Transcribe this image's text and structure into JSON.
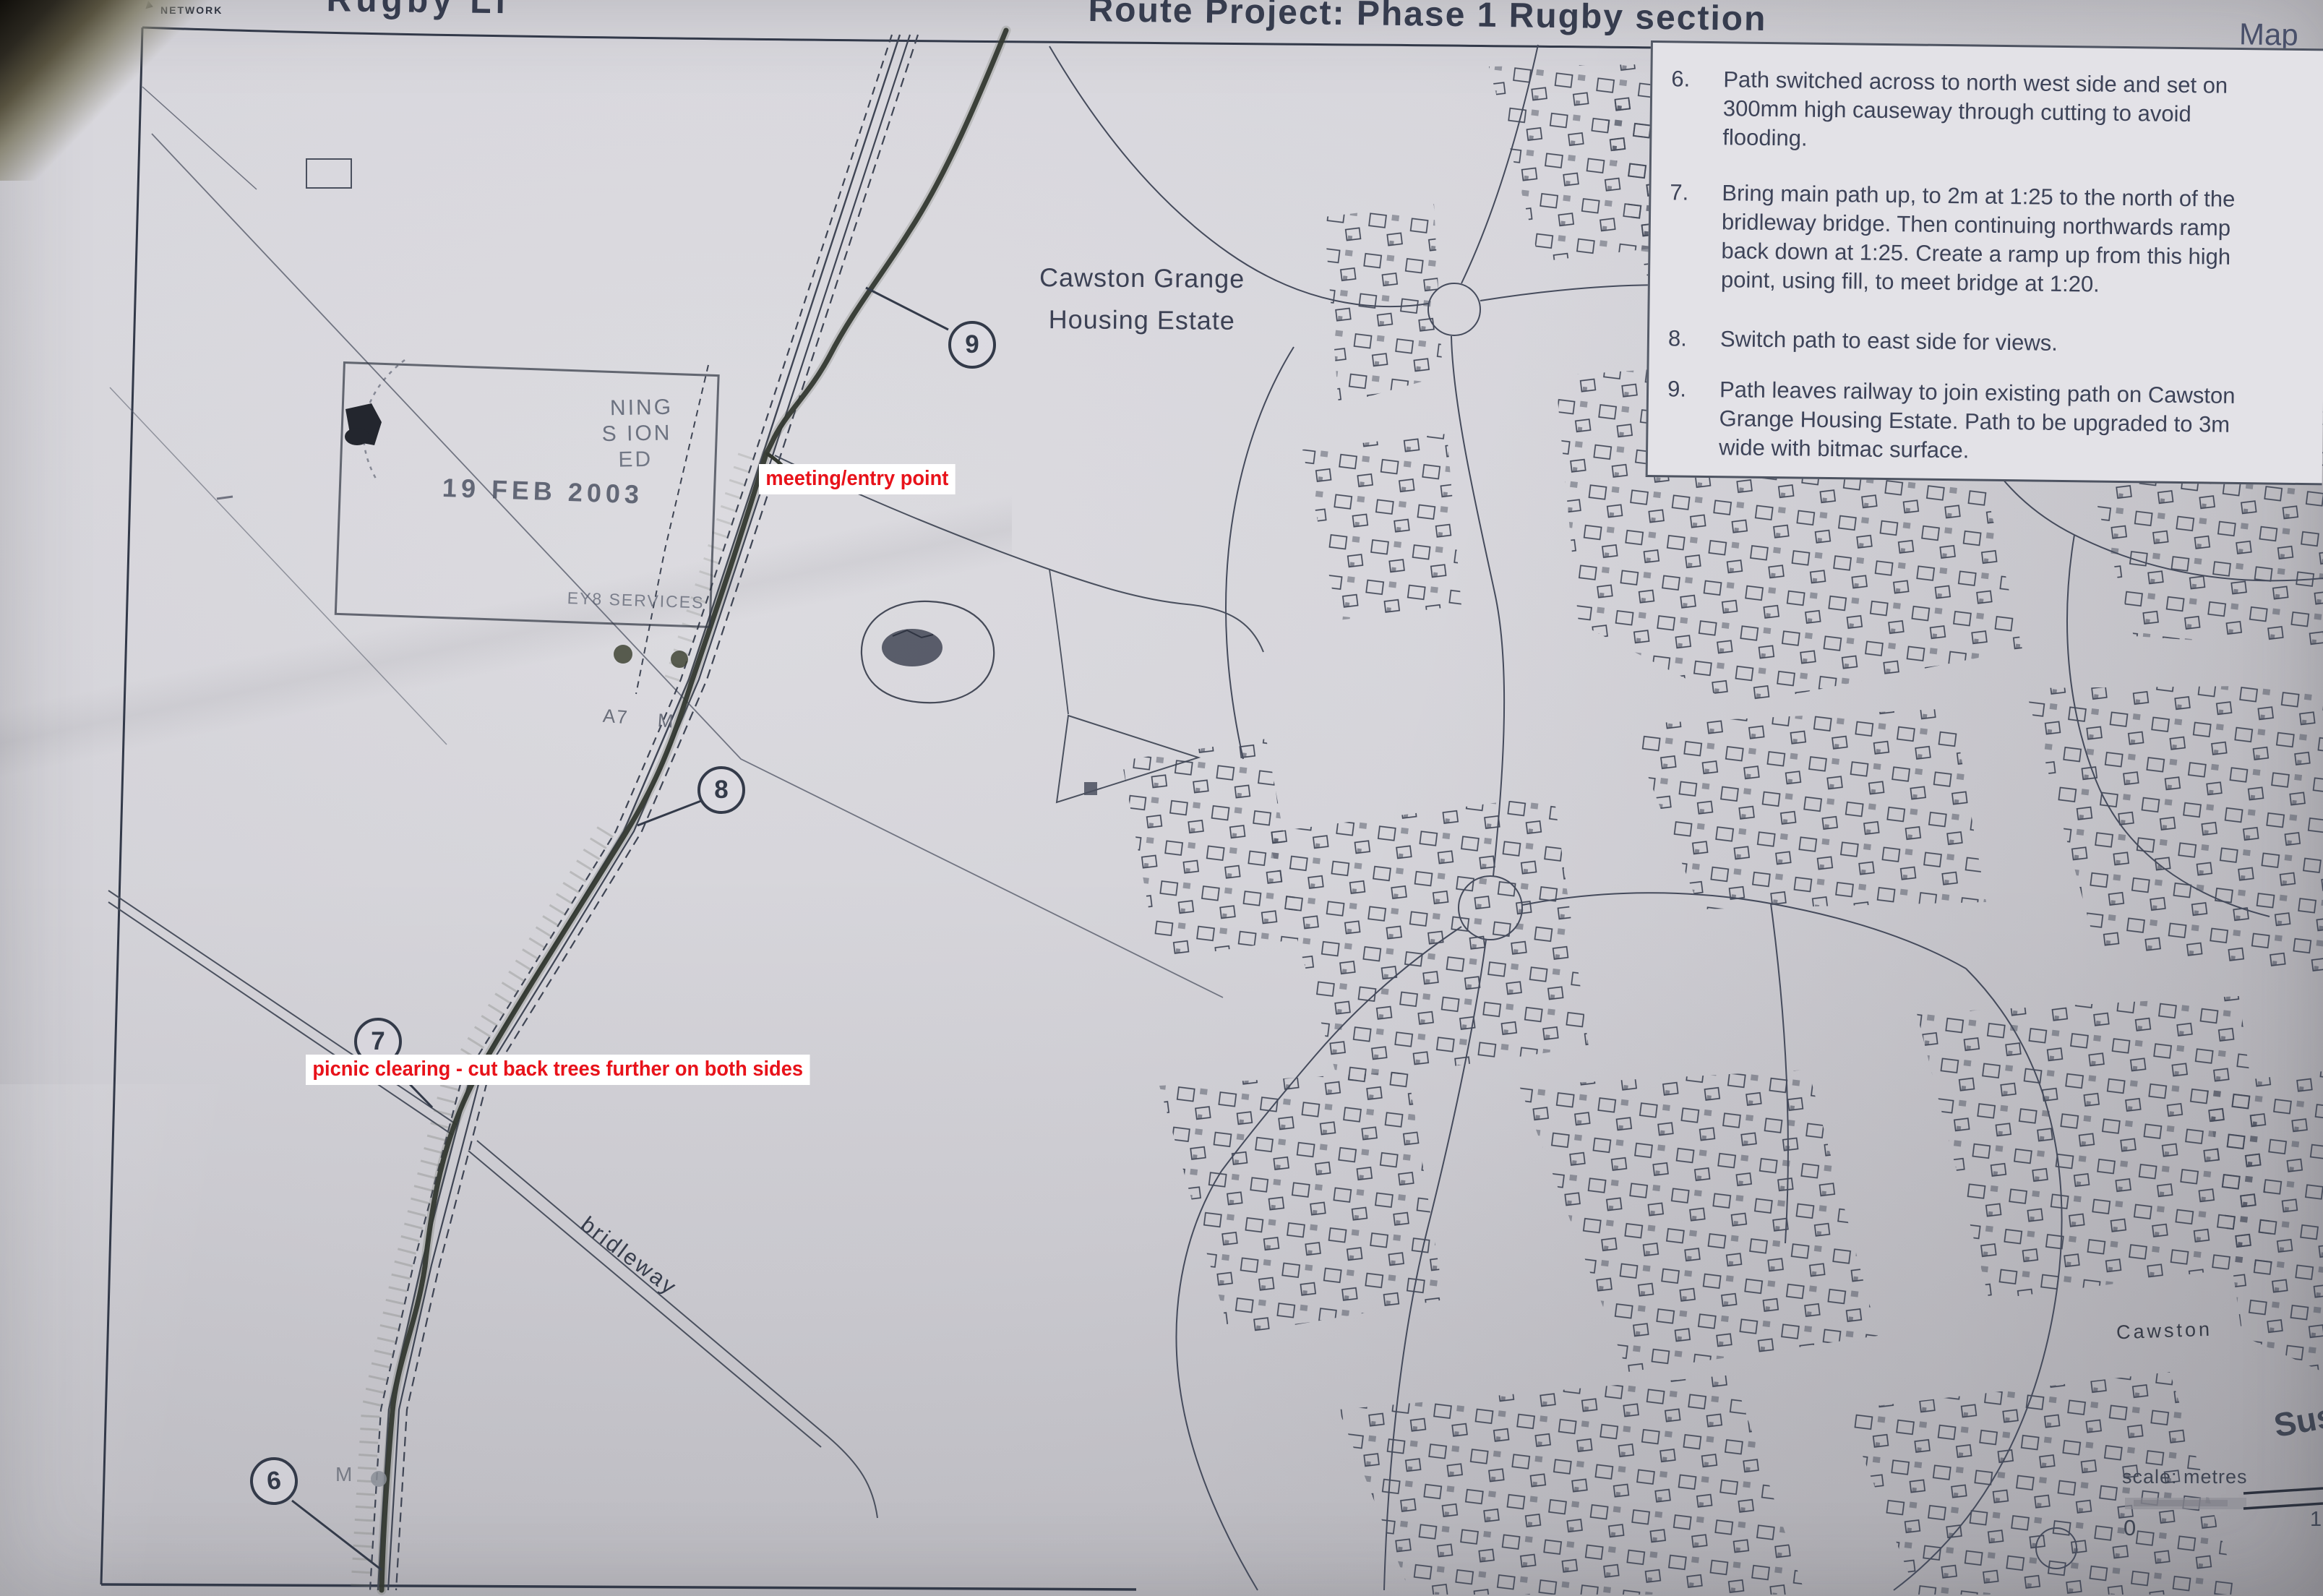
{
  "header": {
    "network": "NETWORK",
    "title_fragment": "Rugby Li",
    "title": "Route Project: Phase 1 Rugby section",
    "map_label": "Map"
  },
  "notes": {
    "items": [
      {
        "num": "6.",
        "lines": [
          "Path switched across to north west side and set on",
          "300mm high causeway through cutting to avoid",
          "flooding."
        ]
      },
      {
        "num": "7.",
        "lines": [
          "Bring main path up, to 2m at 1:25 to the north of the",
          "bridleway bridge. Then continuing northwards ramp",
          "back down at 1:25. Create a ramp up from this high",
          "point, using fill, to meet bridge at 1:20."
        ]
      },
      {
        "num": "8.",
        "lines": [
          "Switch path to east side for views."
        ]
      },
      {
        "num": "9.",
        "lines": [
          "Path leaves railway to join existing path on Cawston",
          "Grange Housing Estate. Path to be upgraded to 3m",
          "wide with bitmac surface."
        ]
      }
    ]
  },
  "annotations": {
    "red_color": "#e8121a",
    "meeting_entry": "meeting/entry point",
    "picnic_clearing": "picnic clearing - cut back trees further on both sides"
  },
  "markers": {
    "m6": "6",
    "m7": "7",
    "m8": "8",
    "m9": "9"
  },
  "map_labels": {
    "estate_line1": "Cawston Grange",
    "estate_line2": "Housing Estate",
    "bridleway": "bridleway",
    "cawston": "Cawston",
    "handwriting_fragment": "Sus",
    "a7": "A7",
    "m_upper": "M",
    "m_lower": "M"
  },
  "stamp": {
    "frag1": "NING",
    "frag2": "S ION",
    "frag3": "ED",
    "date": "19 FEB 2003",
    "services": "EY8 SERVICES"
  },
  "scalebar": {
    "label": "scale: metres",
    "zero": "0",
    "right_tick": "1"
  }
}
